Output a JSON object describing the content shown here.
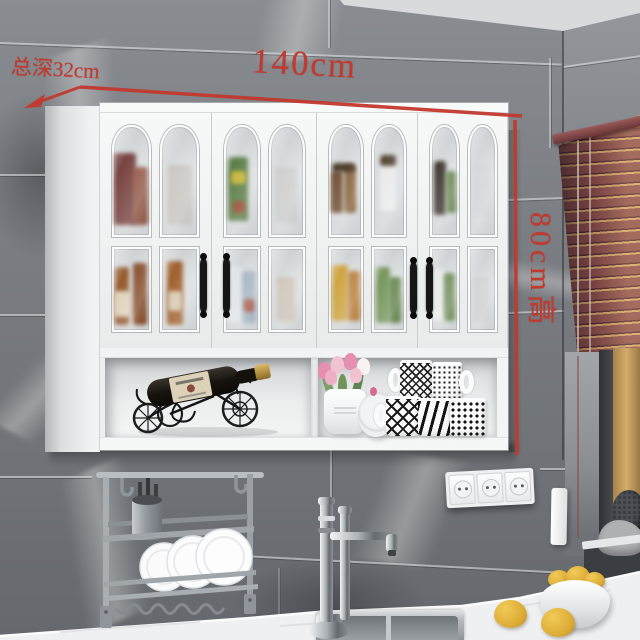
{
  "scene": {
    "title": "White kitchen wall cabinet on gray marble tile wall",
    "annotations": {
      "depth": "总深32cm",
      "width": "140cm",
      "height": "80cm高",
      "color": "#c2392e"
    },
    "cabinet": {
      "door_count": "4",
      "style": "arched four-pane glass doors",
      "finish_color": "#f2f3f4",
      "handle_color": "#161616",
      "open_shelf_items_left": "bicycle-shaped iron wine rack with wine bottle",
      "open_shelf_items_right": "tulip pot, round lid, patterned mugs"
    },
    "environment": {
      "wall_color": "#797c81",
      "blinds_color": "#8a4b49",
      "window_light_color": "#d4ac6c",
      "counter_color": "#eef0f1",
      "items": "dish rack with plates, chrome faucet, sink, triple power outlet, fruit bowl"
    }
  }
}
